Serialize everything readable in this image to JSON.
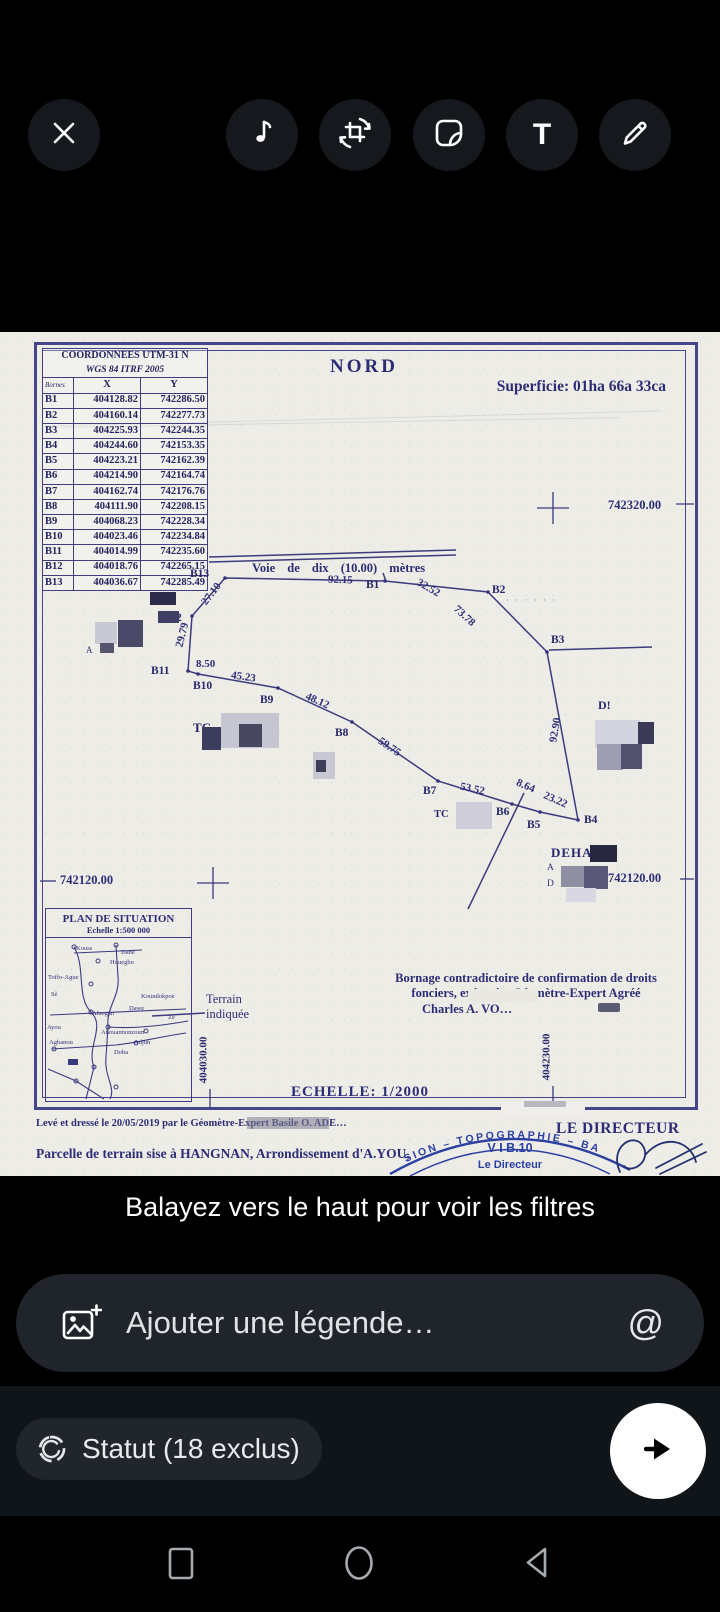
{
  "editor": {
    "toolbar": {
      "close_icon": "close-icon",
      "icons": [
        "music-icon",
        "crop-rotate-icon",
        "sticker-icon",
        "text-icon",
        "draw-icon"
      ],
      "text_tool_glyph": "T"
    }
  },
  "document": {
    "coord_table": {
      "title_line1": "COORDONNEES UTM-31 N",
      "title_line2": "WGS 84 ITRF 2005",
      "columns": [
        "Bornes",
        "X",
        "Y"
      ],
      "rows": [
        [
          "B1",
          "404128.82",
          "742286.50"
        ],
        [
          "B2",
          "404160.14",
          "742277.73"
        ],
        [
          "B3",
          "404225.93",
          "742244.35"
        ],
        [
          "B4",
          "404244.60",
          "742153.35"
        ],
        [
          "B5",
          "404223.21",
          "742162.39"
        ],
        [
          "B6",
          "404214.90",
          "742164.74"
        ],
        [
          "B7",
          "404162.74",
          "742176.76"
        ],
        [
          "B8",
          "404111.90",
          "742208.15"
        ],
        [
          "B9",
          "404068.23",
          "742228.34"
        ],
        [
          "B10",
          "404023.46",
          "742234.84"
        ],
        [
          "B11",
          "404014.99",
          "742235.60"
        ],
        [
          "B12",
          "404018.76",
          "742265.15"
        ],
        [
          "B13",
          "404036.67",
          "742285.49"
        ]
      ]
    },
    "north_label": "NORD",
    "superficie": "Superficie: 01ha 66a 33ca",
    "road_label": "Voie  de  dix  (10.00)  mètres",
    "grid_labels": {
      "top_right": "742320.00",
      "mid_left": "742120.00",
      "mid_right": "742120.00",
      "bottom_left": "404030.00",
      "bottom_right": "404230.00"
    },
    "map_labels": [
      "B13",
      "B1",
      "B2",
      "B3",
      "B4",
      "B5",
      "B6",
      "B7",
      "B8",
      "B9",
      "B10",
      "B11",
      "2"
    ],
    "edges": [
      {
        "from": "B13",
        "to": "B1",
        "length": "92.15"
      },
      {
        "from": "B1",
        "to": "B2",
        "length": "32.52"
      },
      {
        "from": "B2",
        "to": "B3",
        "length": "73.78"
      },
      {
        "from": "B3",
        "to": "B4",
        "length": "92.90"
      },
      {
        "from": "B4",
        "to": "B5",
        "length": "23.22"
      },
      {
        "from": "B5",
        "to": "B6",
        "length": "8.64"
      },
      {
        "from": "B6",
        "to": "B7",
        "length": "53.52"
      },
      {
        "from": "B7",
        "to": "B8",
        "length": "59.75"
      },
      {
        "from": "B8",
        "to": "B9",
        "length": "48.12"
      },
      {
        "from": "B9",
        "to": "B10",
        "length": "45.23"
      },
      {
        "from": "B10",
        "to": "B11",
        "length": "8.50"
      },
      {
        "from": "B11",
        "to": "B12",
        "length": "29.79"
      },
      {
        "from": "B12",
        "to": "B13",
        "length": "27.10"
      }
    ],
    "stray_labels": {
      "tc_left": "TC",
      "tc_mid": "TC",
      "d_right": "D!",
      "deha": "DEHA",
      "a_cluster": "A",
      "a_small": "A",
      "d_small": "D",
      "dots": "· · · · · ·"
    },
    "plan_situation": {
      "title": "PLAN DE SITUATION",
      "scale": "Echelle 1:500 000",
      "places": [
        "Kouss",
        "Dane",
        "Houegbo",
        "Toffo-Ague",
        "Sè",
        "Koundokpoe",
        "Dawe",
        "Afsogan",
        "Zè",
        "Ayou",
        "Ahouannonzoun",
        "Agbanou",
        "Adjun",
        "Doba"
      ]
    },
    "terrain_note": {
      "line1": "Terrain",
      "line2": "indiquée"
    },
    "bornage": {
      "line1": "Bornage contradictoire de confirmation de droits",
      "line2": "fonciers, exécuté p        Géomètre-Expert Agréé",
      "line3": "Charles A. VO…"
    },
    "echelle": "ECHELLE: 1/2000",
    "footer_line1": "Levé et dressé le  20/05/2019 par le Géomètre-Expert Basile O. ADE…",
    "footer_line2": "Parcelle de terrain sise à HANGNAN, Arrondissement d'A.YOU,",
    "stamp": {
      "arc_text": "SION – TOPOGRAPHIE – BA",
      "line1": "V I B.10",
      "line2": "Le Directeur"
    },
    "director_label": "LE DIRECTEUR"
  },
  "filter_hint": "Balayez vers le haut pour voir les filtres",
  "caption_bar": {
    "placeholder": "Ajouter une légende…",
    "mention_symbol": "@"
  },
  "status_row": {
    "label": "Statut (18 exclus)"
  },
  "colors": {
    "paper": "#edece7",
    "ink": "#2d2d77",
    "stamp_blue": "#2c3fa3",
    "send_fab": "#ffffff"
  }
}
